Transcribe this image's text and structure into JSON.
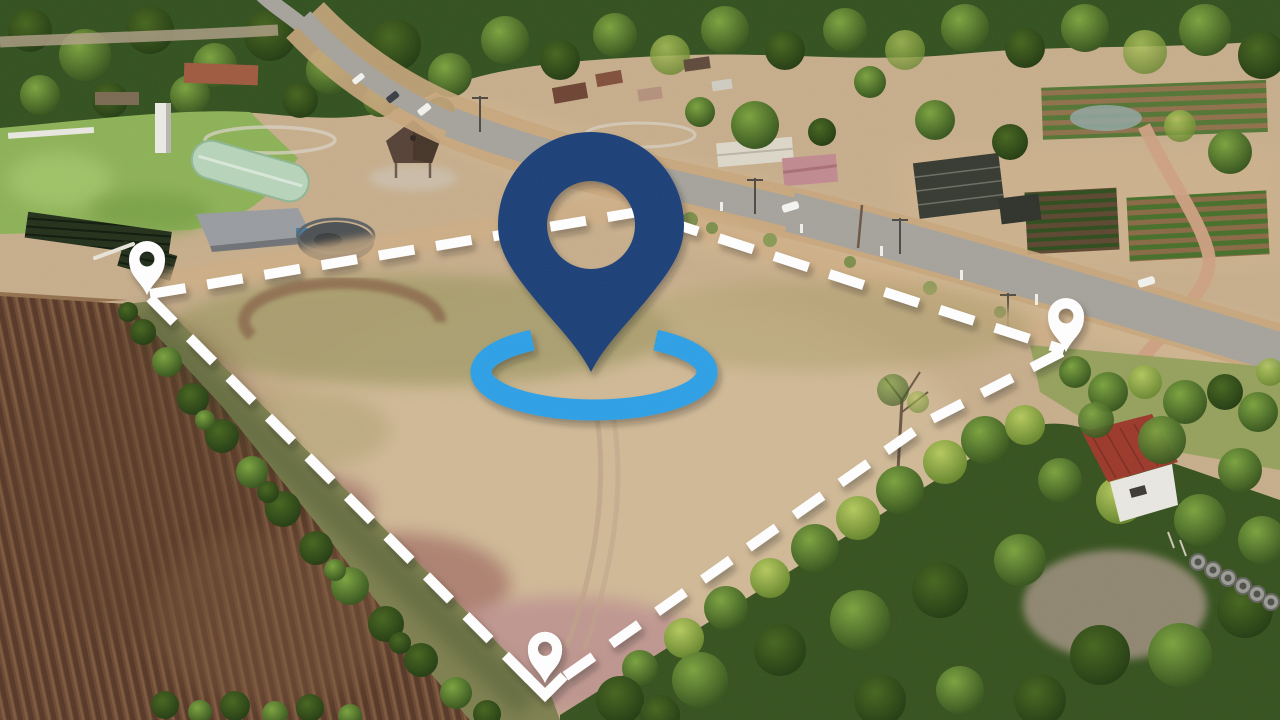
{
  "scene": {
    "title": "Aerial land plot photograph",
    "description": "Drone photo of a rural vacant land plot marked for sale: white dashed boundary with corner pins, large navy location pin over a light-blue ellipse ring, highway and farm village behind, plowed field left, woodland right."
  },
  "overlay": {
    "main_pin": {
      "name": "primary-location-pin",
      "color": "#1d4078"
    },
    "ring": {
      "name": "location-ring",
      "color": "#2ea0e6"
    },
    "boundary": {
      "name": "plot-boundary",
      "color": "#ffffff",
      "style": "dashed",
      "corners": 4
    },
    "corner_pins": [
      {
        "name": "corner-pin-left",
        "color": "#ffffff"
      },
      {
        "name": "corner-pin-right",
        "color": "#ffffff"
      },
      {
        "name": "corner-pin-bottom",
        "color": "#ffffff"
      }
    ]
  }
}
